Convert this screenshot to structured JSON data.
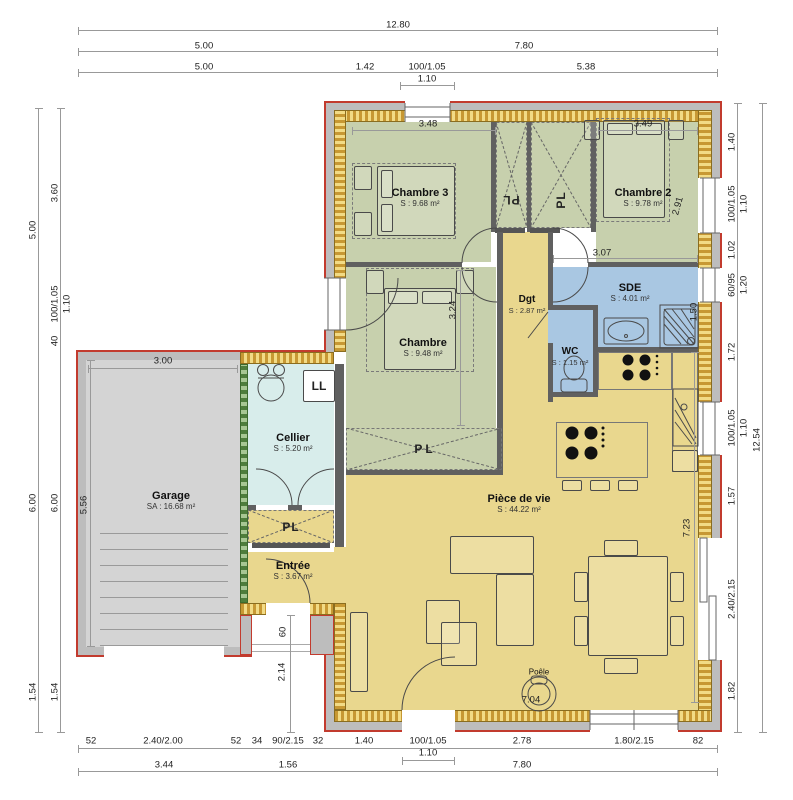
{
  "rooms": {
    "chambre3": {
      "name": "Chambre 3",
      "area": "S : 9.68 m²"
    },
    "chambre2": {
      "name": "Chambre 2",
      "area": "S : 9.78 m²"
    },
    "chambre": {
      "name": "Chambre",
      "area": "S : 9.48 m²"
    },
    "sde": {
      "name": "SDE",
      "area": "S : 4.01 m²"
    },
    "wc": {
      "name": "WC",
      "area": "S : 1.15 m²"
    },
    "dgt": {
      "name": "Dgt",
      "area": "S : 2.87 m²"
    },
    "cellier": {
      "name": "Cellier",
      "area": "S : 5.20 m²"
    },
    "garage": {
      "name": "Garage",
      "area": "SA : 16.68 m²"
    },
    "entree": {
      "name": "Entrée",
      "area": "S : 3.67 m²"
    },
    "piece_de_vie": {
      "name": "Pièce de vie",
      "area": "S : 44.22 m²"
    }
  },
  "labels": {
    "pl": "PL",
    "ll": "LL",
    "poele": "Poêle"
  },
  "colors": {
    "bedroom_green": "#c7d0ad",
    "wet_blue": "#a9c7e2",
    "living_yellow": "#e9d78e",
    "cellier_cyan": "#d8edeb",
    "garage_gray": "#d4d4d4",
    "outline_red": "#c23b2e",
    "wall_hatch": "#c79833",
    "insulation_green": "#4e7d3c",
    "partition_gray": "#606060"
  },
  "dim_labels": [
    {
      "t": "12.80",
      "x": 398,
      "y": 25,
      "r": 0
    },
    {
      "t": "5.00",
      "x": 204,
      "y": 46,
      "r": 0
    },
    {
      "t": "7.80",
      "x": 524,
      "y": 46,
      "r": 0
    },
    {
      "t": "5.00",
      "x": 204,
      "y": 67,
      "r": 0
    },
    {
      "t": "1.42",
      "x": 365,
      "y": 67,
      "r": 0
    },
    {
      "t": "100/1.05",
      "x": 427,
      "y": 67,
      "r": 0
    },
    {
      "t": "1.10",
      "x": 427,
      "y": 79,
      "r": 0
    },
    {
      "t": "5.38",
      "x": 586,
      "y": 67,
      "r": 0
    },
    {
      "t": "52",
      "x": 91,
      "y": 741,
      "r": 0
    },
    {
      "t": "2.40/2.00",
      "x": 163,
      "y": 741,
      "r": 0
    },
    {
      "t": "52",
      "x": 236,
      "y": 741,
      "r": 0
    },
    {
      "t": "34",
      "x": 257,
      "y": 741,
      "r": 0
    },
    {
      "t": "90/2.15",
      "x": 288,
      "y": 741,
      "r": 0
    },
    {
      "t": "32",
      "x": 318,
      "y": 741,
      "r": 0
    },
    {
      "t": "1.40",
      "x": 364,
      "y": 741,
      "r": 0
    },
    {
      "t": "100/1.05",
      "x": 428,
      "y": 741,
      "r": 0
    },
    {
      "t": "1.10",
      "x": 428,
      "y": 753,
      "r": 0
    },
    {
      "t": "2.78",
      "x": 522,
      "y": 741,
      "r": 0
    },
    {
      "t": "1.80/2.15",
      "x": 634,
      "y": 741,
      "r": 0
    },
    {
      "t": "82",
      "x": 698,
      "y": 741,
      "r": 0
    },
    {
      "t": "3.44",
      "x": 164,
      "y": 765,
      "r": 0
    },
    {
      "t": "1.56",
      "x": 288,
      "y": 765,
      "r": 0
    },
    {
      "t": "7.80",
      "x": 522,
      "y": 765,
      "r": 0
    },
    {
      "t": "5.00",
      "x": 33,
      "y": 230,
      "r": -90
    },
    {
      "t": "3.60",
      "x": 55,
      "y": 193,
      "r": -90
    },
    {
      "t": "100/1.05",
      "x": 55,
      "y": 304,
      "r": -90
    },
    {
      "t": "1.10",
      "x": 67,
      "y": 304,
      "r": -90
    },
    {
      "t": "40",
      "x": 55,
      "y": 341,
      "r": -90
    },
    {
      "t": "6.00",
      "x": 33,
      "y": 503,
      "r": -90
    },
    {
      "t": "6.00",
      "x": 55,
      "y": 503,
      "r": -90
    },
    {
      "t": "1.54",
      "x": 33,
      "y": 692,
      "r": -90
    },
    {
      "t": "1.54",
      "x": 55,
      "y": 692,
      "r": -90
    },
    {
      "t": "1.40",
      "x": 732,
      "y": 142,
      "r": -90
    },
    {
      "t": "100/1.05",
      "x": 732,
      "y": 204,
      "r": -90
    },
    {
      "t": "1.10",
      "x": 744,
      "y": 204,
      "r": -90
    },
    {
      "t": "1.02",
      "x": 732,
      "y": 250,
      "r": -90
    },
    {
      "t": "60/95",
      "x": 732,
      "y": 285,
      "r": -90
    },
    {
      "t": "1.20",
      "x": 744,
      "y": 285,
      "r": -90
    },
    {
      "t": "1.72",
      "x": 732,
      "y": 352,
      "r": -90
    },
    {
      "t": "100/1.05",
      "x": 732,
      "y": 428,
      "r": -90
    },
    {
      "t": "1.10",
      "x": 744,
      "y": 428,
      "r": -90
    },
    {
      "t": "12.54",
      "x": 757,
      "y": 440,
      "r": -90
    },
    {
      "t": "1.57",
      "x": 732,
      "y": 496,
      "r": -90
    },
    {
      "t": "2.40/2.15",
      "x": 732,
      "y": 599,
      "r": -90
    },
    {
      "t": "1.82",
      "x": 732,
      "y": 691,
      "r": -90
    },
    {
      "t": "3.48",
      "x": 428,
      "y": 124,
      "r": 0
    },
    {
      "t": "3.49",
      "x": 643,
      "y": 124,
      "r": 0
    },
    {
      "t": "3.07",
      "x": 602,
      "y": 253,
      "r": 0
    },
    {
      "t": "2.91",
      "x": 678,
      "y": 206,
      "r": -75
    },
    {
      "t": "1.50",
      "x": 694,
      "y": 312,
      "r": -90
    },
    {
      "t": "3.24",
      "x": 453,
      "y": 310,
      "r": -90
    },
    {
      "t": "3.00",
      "x": 163,
      "y": 361,
      "r": 0
    },
    {
      "t": "5.56",
      "x": 84,
      "y": 505,
      "r": -90
    },
    {
      "t": "7.23",
      "x": 687,
      "y": 528,
      "r": -90
    },
    {
      "t": "60",
      "x": 283,
      "y": 632,
      "r": -90
    },
    {
      "t": "2.14",
      "x": 282,
      "y": 672,
      "r": -90
    },
    {
      "t": "7.04",
      "x": 531,
      "y": 700,
      "r": 0
    }
  ]
}
